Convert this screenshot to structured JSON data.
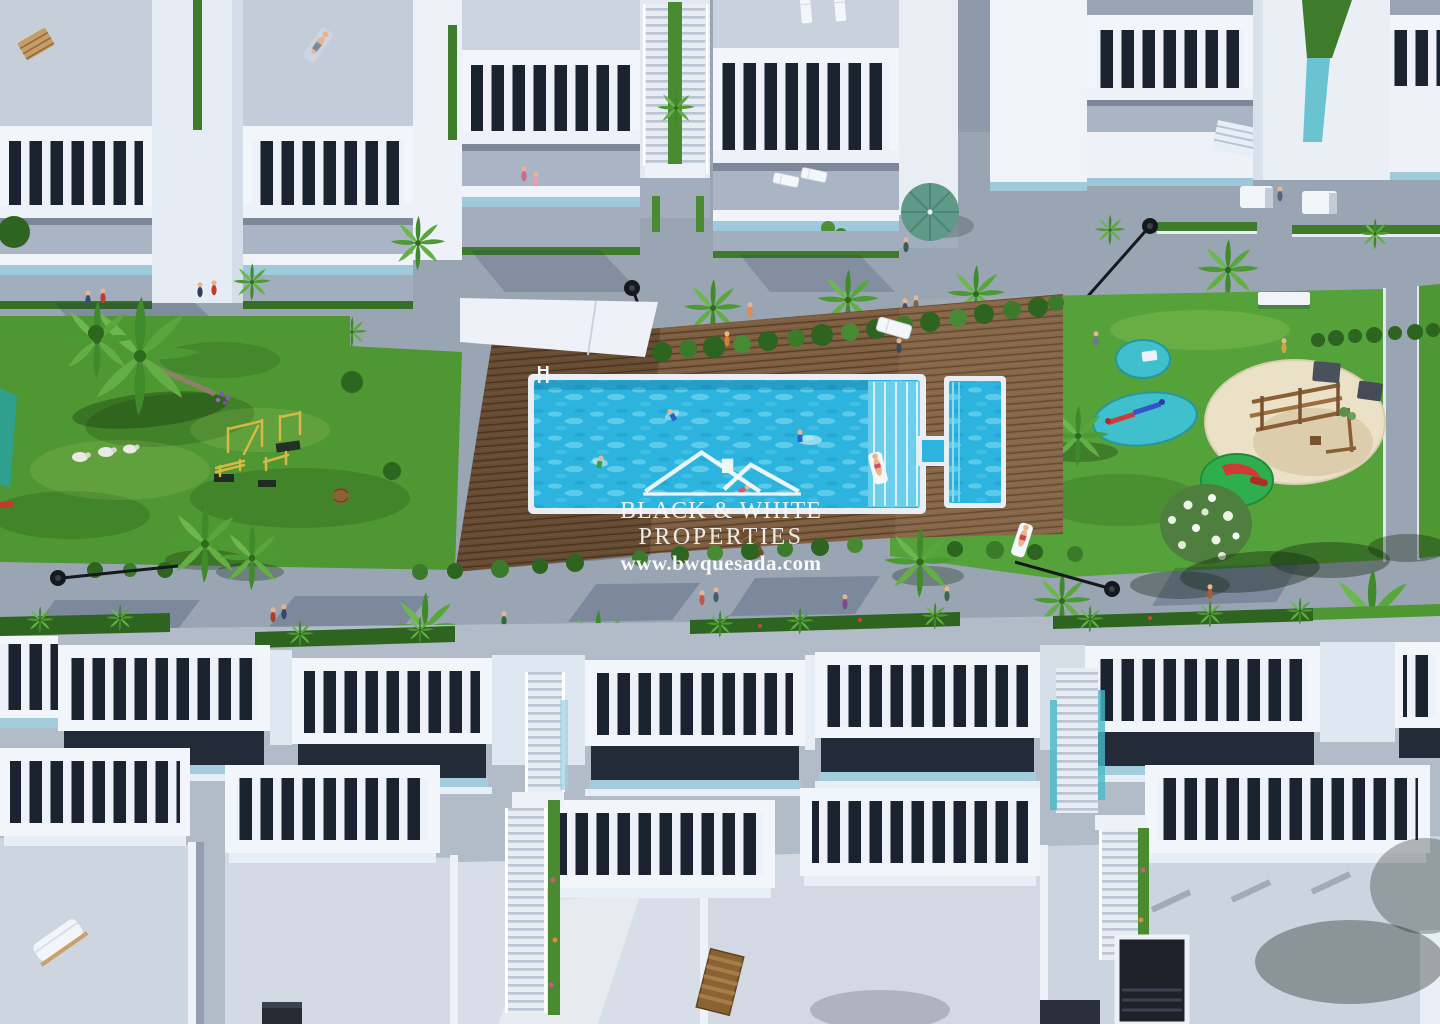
{
  "watermark": {
    "brand_line1": "BLACK & WHITE",
    "brand_line2": "PROPERTIES",
    "website": "www.bwquesada.com",
    "logo_icon": "house-rooftops-icon",
    "text_color": "#f5f7f7"
  },
  "palette": {
    "concrete_walkway": "#9aa5b4",
    "building_white": "#f2f5fa",
    "terrace_grey": "#a9b4c4",
    "pergola_interior_dark": "#1b2230",
    "glass_balustrade_blue": "#9fd0e2",
    "lawn_green": "#4f9733",
    "hedge_green": "#2d6420",
    "deck_wood_brown": "#7d5e41",
    "pool_water_blue": "#2cb4de",
    "pool_steps_blue": "#6fd0ea",
    "splash_pad_teal": "#3fc0cc",
    "playground_sand": "#ebe1c7",
    "play_frame_wood": "#8a5f34",
    "outdoor_gym_yellow": "#d4b944",
    "parasol_green": "#5f9a88",
    "street_lamp_black": "#15181d"
  }
}
